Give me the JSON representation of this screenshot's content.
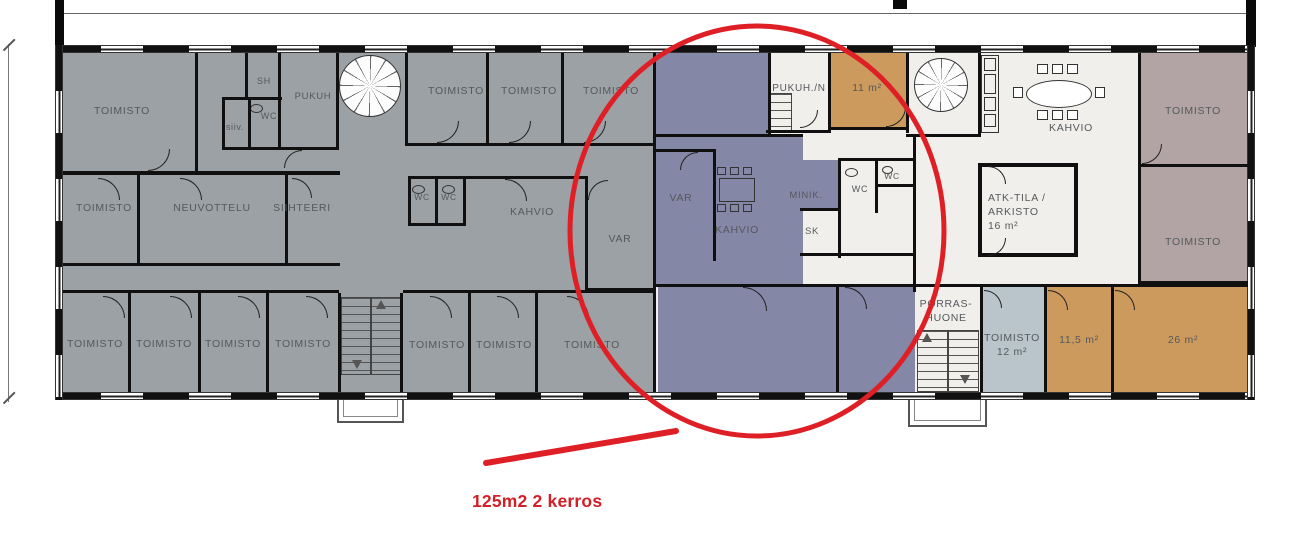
{
  "annotation": {
    "area_label": "125m2 2 kerros"
  },
  "colors": {
    "gray": "#9ba1a4",
    "purple": "#8487a6",
    "orange": "#cd9a5e",
    "mauve": "#b2a4a4",
    "blue": "#b9c5cb",
    "floor": "#f0efec",
    "wall": "#101010",
    "label": "#55595c",
    "red": "#d32027"
  },
  "plan": {
    "rooms": [
      {
        "n": "open-office-purple-top",
        "f": "purple",
        "x": 656,
        "y": 53,
        "w": 112,
        "h": 84
      },
      {
        "n": "var-kahvio-purple",
        "f": "purple",
        "x": 656,
        "y": 137,
        "w": 147,
        "h": 150
      },
      {
        "n": "minikitchen-purple",
        "f": "purple",
        "x": 800,
        "y": 160,
        "w": 38,
        "h": 50
      },
      {
        "n": "open-office-purple-bottom-left",
        "f": "purple",
        "x": 658,
        "y": 287,
        "w": 178,
        "h": 105
      },
      {
        "n": "open-office-purple-bottom-right",
        "f": "purple",
        "x": 838,
        "y": 285,
        "w": 77,
        "h": 107
      },
      {
        "n": "room-11m2",
        "f": "orange",
        "x": 830,
        "y": 53,
        "w": 77,
        "h": 77
      },
      {
        "n": "room-11-5m2",
        "f": "orange",
        "x": 1046,
        "y": 287,
        "w": 66,
        "h": 105
      },
      {
        "n": "room-26m2",
        "f": "orange",
        "x": 1113,
        "y": 287,
        "w": 135,
        "h": 105
      },
      {
        "n": "toimisto-mauve-top",
        "f": "mauve",
        "x": 1140,
        "y": 53,
        "w": 108,
        "h": 113
      },
      {
        "n": "toimisto-mauve-bottom",
        "f": "mauve",
        "x": 1140,
        "y": 166,
        "w": 108,
        "h": 116
      },
      {
        "n": "toimisto-12m2-blue",
        "f": "blue",
        "x": 982,
        "y": 287,
        "w": 62,
        "h": 105
      },
      {
        "n": "atk-arkisto-room",
        "f": "floor",
        "x": 978,
        "y": 163,
        "w": 100,
        "h": 94,
        "b": 4
      }
    ],
    "walls": [
      [
        653,
        53,
        3,
        339
      ],
      [
        195,
        53,
        3,
        120
      ],
      [
        63,
        171,
        277,
        4
      ],
      [
        63,
        263,
        277,
        3
      ],
      [
        137,
        175,
        3,
        88
      ],
      [
        285,
        175,
        3,
        88
      ],
      [
        245,
        53,
        3,
        47
      ],
      [
        222,
        97,
        60,
        3
      ],
      [
        222,
        97,
        3,
        53
      ],
      [
        248,
        100,
        3,
        50
      ],
      [
        278,
        53,
        3,
        97
      ],
      [
        222,
        147,
        117,
        3
      ],
      [
        336,
        53,
        3,
        97
      ],
      [
        405,
        53,
        3,
        92
      ],
      [
        405,
        143,
        251,
        3
      ],
      [
        486,
        53,
        3,
        92
      ],
      [
        561,
        53,
        3,
        92
      ],
      [
        408,
        176,
        58,
        3
      ],
      [
        408,
        223,
        58,
        3
      ],
      [
        408,
        176,
        3,
        50
      ],
      [
        435,
        176,
        3,
        50
      ],
      [
        463,
        176,
        3,
        50
      ],
      [
        463,
        176,
        125,
        3
      ],
      [
        585,
        176,
        3,
        115
      ],
      [
        585,
        288,
        71,
        3
      ],
      [
        63,
        290,
        276,
        3
      ],
      [
        403,
        290,
        253,
        3
      ],
      [
        128,
        293,
        3,
        99
      ],
      [
        198,
        293,
        3,
        99
      ],
      [
        266,
        293,
        3,
        99
      ],
      [
        338,
        293,
        3,
        99
      ],
      [
        400,
        293,
        3,
        99
      ],
      [
        468,
        293,
        3,
        99
      ],
      [
        535,
        293,
        3,
        99
      ],
      [
        768,
        53,
        3,
        84
      ],
      [
        656,
        134,
        147,
        3
      ],
      [
        656,
        149,
        60,
        3
      ],
      [
        713,
        151,
        3,
        110
      ],
      [
        828,
        53,
        3,
        80
      ],
      [
        766,
        130,
        65,
        3
      ],
      [
        906,
        53,
        3,
        80
      ],
      [
        830,
        127,
        79,
        3
      ],
      [
        838,
        158,
        77,
        3
      ],
      [
        838,
        158,
        3,
        100
      ],
      [
        875,
        158,
        3,
        55
      ],
      [
        878,
        184,
        37,
        3
      ],
      [
        800,
        208,
        40,
        3
      ],
      [
        800,
        253,
        115,
        3
      ],
      [
        913,
        134,
        3,
        158
      ],
      [
        906,
        134,
        75,
        3
      ],
      [
        978,
        53,
        3,
        82
      ],
      [
        656,
        284,
        259,
        3
      ],
      [
        915,
        284,
        333,
        3
      ],
      [
        836,
        287,
        3,
        105
      ],
      [
        980,
        287,
        3,
        105
      ],
      [
        1044,
        287,
        3,
        105
      ],
      [
        1111,
        287,
        3,
        105
      ],
      [
        1138,
        53,
        3,
        232
      ],
      [
        1138,
        164,
        110,
        3
      ],
      [
        1138,
        281,
        110,
        3
      ]
    ],
    "doors": [
      {
        "x": 148,
        "y": 149,
        "r": 22,
        "o": "br"
      },
      {
        "x": 284,
        "y": 150,
        "r": 18,
        "o": "tl"
      },
      {
        "x": 437,
        "y": 121,
        "r": 22,
        "o": "br"
      },
      {
        "x": 509,
        "y": 121,
        "r": 22,
        "o": "br"
      },
      {
        "x": 584,
        "y": 121,
        "r": 22,
        "o": "br"
      },
      {
        "x": 98,
        "y": 178,
        "r": 22,
        "o": "tr"
      },
      {
        "x": 180,
        "y": 178,
        "r": 22,
        "o": "tr"
      },
      {
        "x": 292,
        "y": 178,
        "r": 20,
        "o": "tr"
      },
      {
        "x": 505,
        "y": 179,
        "r": 22,
        "o": "tr"
      },
      {
        "x": 588,
        "y": 180,
        "r": 20,
        "o": "tl"
      },
      {
        "x": 103,
        "y": 296,
        "r": 22,
        "o": "tr"
      },
      {
        "x": 170,
        "y": 296,
        "r": 22,
        "o": "tr"
      },
      {
        "x": 238,
        "y": 296,
        "r": 22,
        "o": "tr"
      },
      {
        "x": 306,
        "y": 296,
        "r": 22,
        "o": "tr"
      },
      {
        "x": 430,
        "y": 296,
        "r": 22,
        "o": "tr"
      },
      {
        "x": 497,
        "y": 296,
        "r": 22,
        "o": "tr"
      },
      {
        "x": 567,
        "y": 296,
        "r": 22,
        "o": "tr"
      },
      {
        "x": 743,
        "y": 287,
        "r": 24,
        "o": "tr"
      },
      {
        "x": 845,
        "y": 287,
        "r": 22,
        "o": "tr"
      },
      {
        "x": 984,
        "y": 290,
        "r": 18,
        "o": "tr"
      },
      {
        "x": 1048,
        "y": 290,
        "r": 20,
        "o": "tr"
      },
      {
        "x": 1115,
        "y": 290,
        "r": 20,
        "o": "tr"
      },
      {
        "x": 1142,
        "y": 144,
        "r": 20,
        "o": "br"
      },
      {
        "x": 988,
        "y": 166,
        "r": 18,
        "o": "tr"
      },
      {
        "x": 988,
        "y": 238,
        "r": 18,
        "o": "br"
      },
      {
        "x": 886,
        "y": 107,
        "r": 20,
        "o": "br"
      },
      {
        "x": 800,
        "y": 110,
        "r": 18,
        "o": "br"
      },
      {
        "x": 680,
        "y": 152,
        "r": 18,
        "o": "tl"
      }
    ],
    "stairs": [
      {
        "x": 341,
        "y": 297,
        "w": 60,
        "h": 78,
        "div": true
      },
      {
        "x": 917,
        "y": 330,
        "w": 62,
        "h": 62,
        "div": true
      },
      {
        "x": 770,
        "y": 93,
        "w": 22,
        "h": 40,
        "div": false
      }
    ],
    "spirals": [
      {
        "x": 339,
        "y": 55,
        "d": 62
      },
      {
        "x": 914,
        "y": 58,
        "d": 54
      }
    ],
    "canopies": [
      {
        "x": 337,
        "y": 392,
        "w": 67,
        "h": 31
      },
      {
        "x": 908,
        "y": 392,
        "w": 79,
        "h": 35
      }
    ],
    "tris": [
      {
        "x": 376,
        "y": 300,
        "d": "up"
      },
      {
        "x": 352,
        "y": 360,
        "d": "down"
      },
      {
        "x": 922,
        "y": 333,
        "d": "up"
      },
      {
        "x": 960,
        "y": 375,
        "d": "down"
      }
    ],
    "fixtures": [
      {
        "x": 250,
        "y": 104,
        "w": 13,
        "h": 9,
        "e": 1
      },
      {
        "x": 412,
        "y": 185,
        "w": 13,
        "h": 9,
        "e": 1
      },
      {
        "x": 442,
        "y": 185,
        "w": 13,
        "h": 9,
        "e": 1
      },
      {
        "x": 845,
        "y": 168,
        "w": 13,
        "h": 9,
        "e": 1
      },
      {
        "x": 882,
        "y": 166,
        "w": 11,
        "h": 8,
        "e": 1
      },
      {
        "x": 717,
        "y": 167,
        "w": 9,
        "h": 8
      },
      {
        "x": 730,
        "y": 167,
        "w": 9,
        "h": 8
      },
      {
        "x": 743,
        "y": 167,
        "w": 9,
        "h": 8
      },
      {
        "x": 717,
        "y": 204,
        "w": 9,
        "h": 8
      },
      {
        "x": 730,
        "y": 204,
        "w": 9,
        "h": 8
      },
      {
        "x": 743,
        "y": 204,
        "w": 9,
        "h": 8
      },
      {
        "x": 719,
        "y": 178,
        "w": 36,
        "h": 24
      },
      {
        "x": 1026,
        "y": 80,
        "w": 66,
        "h": 28,
        "e": 1,
        "w2": 1
      },
      {
        "x": 1037,
        "y": 64,
        "w": 11,
        "h": 10,
        "w2": 1
      },
      {
        "x": 1052,
        "y": 64,
        "w": 11,
        "h": 10,
        "w2": 1
      },
      {
        "x": 1067,
        "y": 64,
        "w": 11,
        "h": 10,
        "w2": 1
      },
      {
        "x": 1037,
        "y": 110,
        "w": 11,
        "h": 10,
        "w2": 1
      },
      {
        "x": 1052,
        "y": 110,
        "w": 11,
        "h": 10,
        "w2": 1
      },
      {
        "x": 1067,
        "y": 110,
        "w": 11,
        "h": 10,
        "w2": 1
      },
      {
        "x": 1013,
        "y": 87,
        "w": 10,
        "h": 11,
        "w2": 1
      },
      {
        "x": 1095,
        "y": 87,
        "w": 10,
        "h": 11,
        "w2": 1
      },
      {
        "x": 981,
        "y": 55,
        "w": 18,
        "h": 78
      },
      {
        "x": 984,
        "y": 58,
        "w": 12,
        "h": 13
      },
      {
        "x": 984,
        "y": 74,
        "w": 12,
        "h": 20
      },
      {
        "x": 984,
        "y": 97,
        "w": 12,
        "h": 14
      },
      {
        "x": 984,
        "y": 114,
        "w": 12,
        "h": 13
      }
    ],
    "labels": [
      {
        "t": "TOIMISTO",
        "x": 122,
        "y": 111
      },
      {
        "t": "SH",
        "x": 264,
        "y": 81,
        "s": 9
      },
      {
        "t": "siiv.",
        "x": 235,
        "y": 127,
        "s": 9
      },
      {
        "t": "WC",
        "x": 269,
        "y": 116,
        "s": 9
      },
      {
        "t": "PUKUH",
        "x": 313,
        "y": 97,
        "s": 9.5
      },
      {
        "t": "TOIMISTO",
        "x": 456,
        "y": 91
      },
      {
        "t": "TOIMISTO",
        "x": 529,
        "y": 91
      },
      {
        "t": "TOIMISTO",
        "x": 611,
        "y": 91
      },
      {
        "t": "TOIMISTO",
        "x": 104,
        "y": 208
      },
      {
        "t": "NEUVOTTELU",
        "x": 212,
        "y": 208
      },
      {
        "t": "SIIHTEERI",
        "x": 302,
        "y": 208
      },
      {
        "t": "WC",
        "x": 422,
        "y": 197,
        "s": 8.5
      },
      {
        "t": "WC",
        "x": 449,
        "y": 197,
        "s": 8.5
      },
      {
        "t": "KAHVIO",
        "x": 532,
        "y": 212
      },
      {
        "t": "VAR",
        "x": 620,
        "y": 239
      },
      {
        "t": "TOIMISTO",
        "x": 95,
        "y": 344
      },
      {
        "t": "TOIMISTO",
        "x": 164,
        "y": 344
      },
      {
        "t": "TOIMISTO",
        "x": 233,
        "y": 344
      },
      {
        "t": "TOIMISTO",
        "x": 303,
        "y": 344
      },
      {
        "t": "TOIMISTO",
        "x": 437,
        "y": 345
      },
      {
        "t": "TOIMISTO",
        "x": 504,
        "y": 345
      },
      {
        "t": "TOIMISTO",
        "x": 592,
        "y": 345
      },
      {
        "t": "PUKUH./N",
        "x": 799,
        "y": 89,
        "s": 10
      },
      {
        "t": "11 m²",
        "x": 867,
        "y": 88
      },
      {
        "t": "VAR",
        "x": 681,
        "y": 198
      },
      {
        "t": "KAHVIO",
        "x": 737,
        "y": 230
      },
      {
        "t": "MINIK.",
        "x": 806,
        "y": 196,
        "s": 9.5
      },
      {
        "t": "SK",
        "x": 812,
        "y": 232,
        "s": 9.5
      },
      {
        "t": "WC",
        "x": 860,
        "y": 189,
        "s": 9
      },
      {
        "t": "WC",
        "x": 892,
        "y": 176,
        "s": 8.5
      },
      {
        "t": "KAHVIO",
        "x": 1071,
        "y": 128
      },
      {
        "t": "ATK-TILA /\nARKISTO\n16 m²",
        "x": 988,
        "y": 212,
        "a": "l"
      },
      {
        "t": "TOIMISTO",
        "x": 1193,
        "y": 111
      },
      {
        "t": "TOIMISTO",
        "x": 1193,
        "y": 242
      },
      {
        "t": "PORRAS-\nHUONE",
        "x": 946,
        "y": 311
      },
      {
        "t": "TOIMISTO\n12 m²",
        "x": 1012,
        "y": 345
      },
      {
        "t": "11,5 m²",
        "x": 1079,
        "y": 340
      },
      {
        "t": "26 m²",
        "x": 1183,
        "y": 340
      }
    ]
  }
}
